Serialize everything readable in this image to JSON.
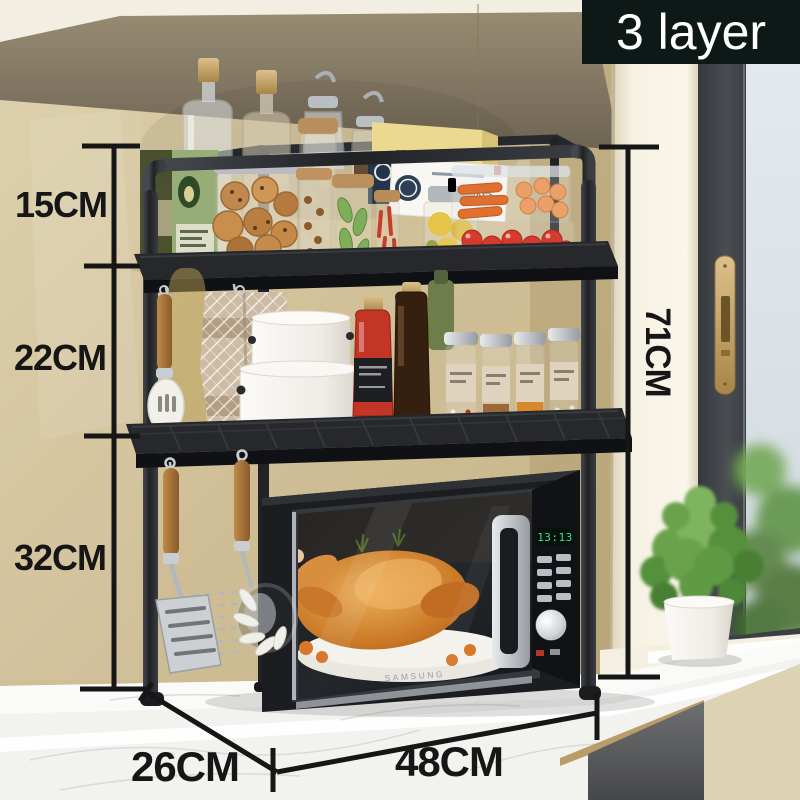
{
  "badge": {
    "label": "3 layer",
    "background": "#0d1817",
    "text_color": "#ffffff"
  },
  "dimensions": {
    "top_tier_height": "15CM",
    "middle_tier_height": "22CM",
    "bottom_tier_height": "32CM",
    "overall_height": "71CM",
    "overall_width": "48CM",
    "overall_depth": "26CM",
    "line_color": "#161616"
  },
  "scene": {
    "microwave": {
      "brand": "SAMSUNG",
      "display_time": "13:13",
      "display_color": "#3fe18f"
    },
    "packages": {
      "cereal_box": "Fibre flakes"
    },
    "palette": {
      "wall": "#cdbb92",
      "rack": "#27292d",
      "countertop": "#f2f1ee",
      "window_frame": "#43464b",
      "window_handle_brass": "#c3a268",
      "plant_green": "#65a04a",
      "towel": "#cdbba4",
      "chicken": "#c97a2e"
    }
  }
}
